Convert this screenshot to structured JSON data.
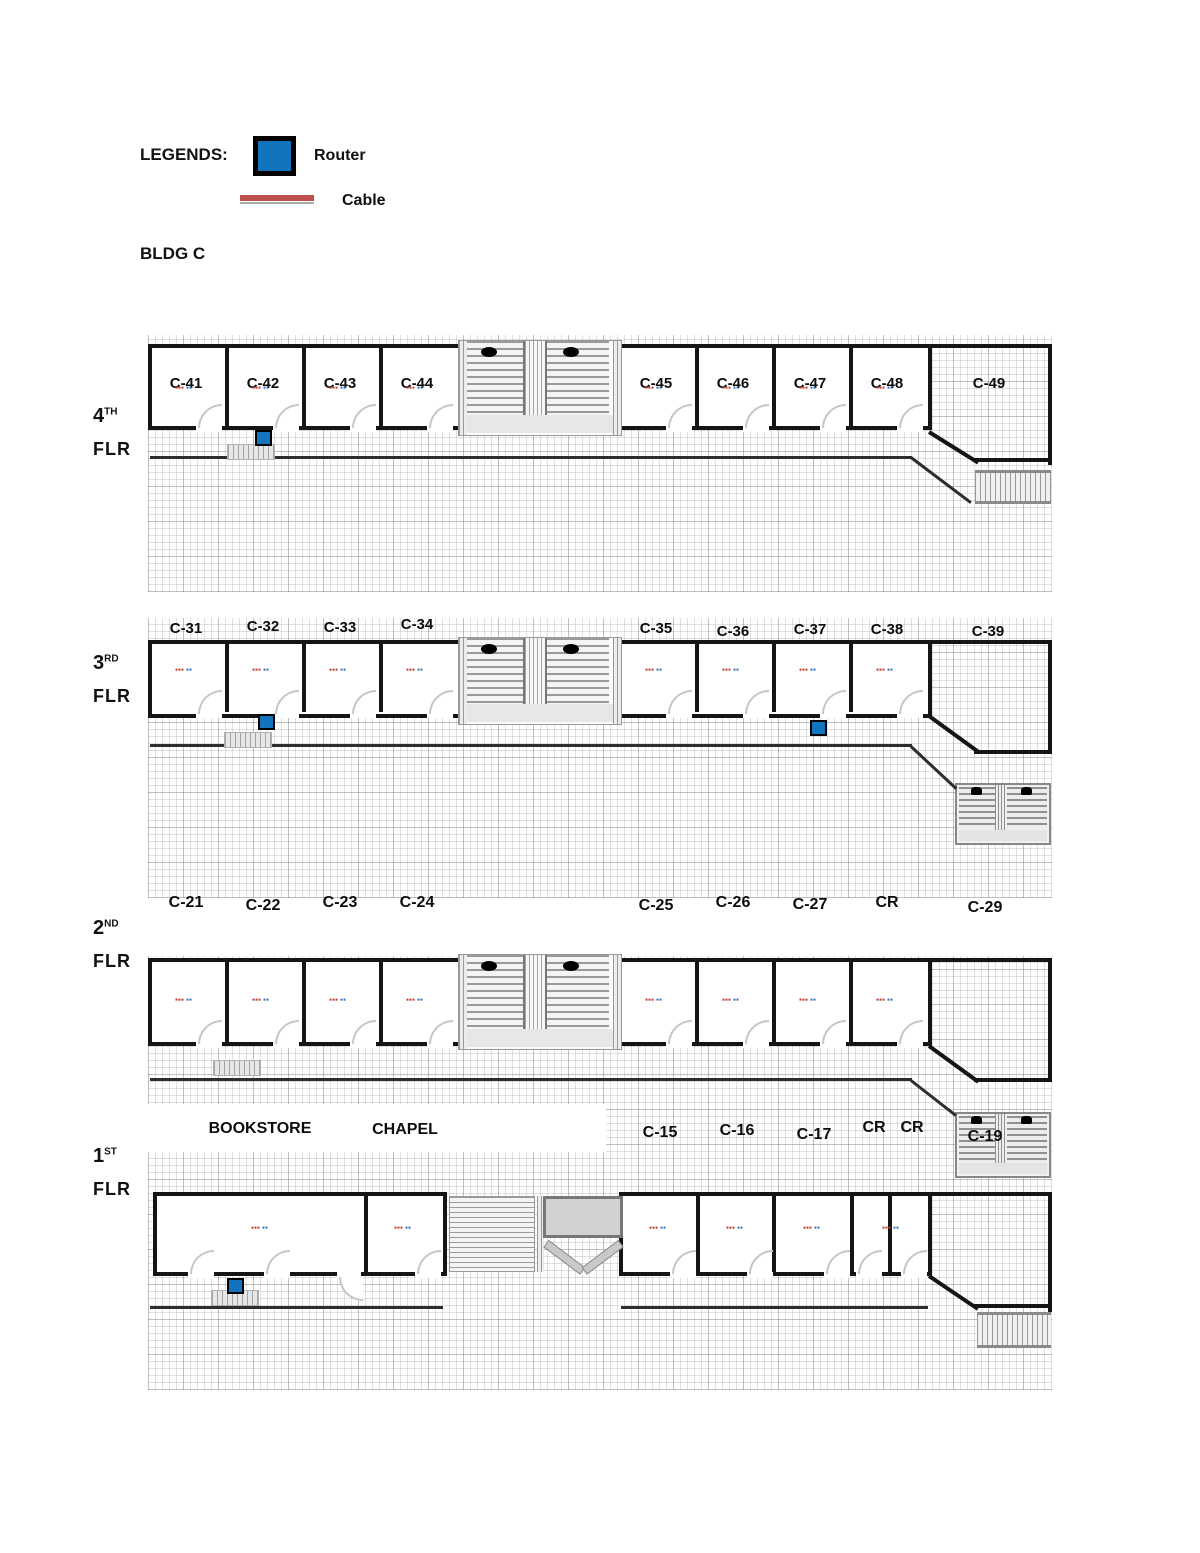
{
  "legend": {
    "title": "LEGENDS:",
    "router": "Router",
    "cable": "Cable"
  },
  "building": "BLDG C",
  "colors": {
    "router_fill": "#1374BE",
    "cable_legend": "#C0504D",
    "wall": "#151515"
  },
  "ip": {
    "red": "▪▪▪",
    "blue": "▪▪"
  },
  "floors": [
    {
      "num": "4",
      "sup": "TH",
      "flr": "FLR",
      "rooms": [
        "C-41",
        "C-42",
        "C-43",
        "C-44",
        "C-45",
        "C-46",
        "C-47",
        "C-48"
      ],
      "corner": "C-49"
    },
    {
      "num": "3",
      "sup": "RD",
      "flr": "FLR",
      "rooms": [
        "C-31",
        "C-32",
        "C-33",
        "C-34",
        "C-35",
        "C-36",
        "C-37",
        "C-38"
      ],
      "corner": "C-39"
    },
    {
      "num": "2",
      "sup": "ND",
      "flr": "FLR",
      "rooms": [
        "C-21",
        "C-22",
        "C-23",
        "C-24",
        "C-25",
        "C-26",
        "C-27",
        "CR"
      ],
      "corner": "C-29"
    },
    {
      "num": "1",
      "sup": "ST",
      "flr": "FLR",
      "rooms": [
        "BOOKSTORE",
        "CHAPEL",
        "C-15",
        "C-16",
        "C-17",
        "CR",
        "CR"
      ],
      "corner": "C-19"
    }
  ]
}
